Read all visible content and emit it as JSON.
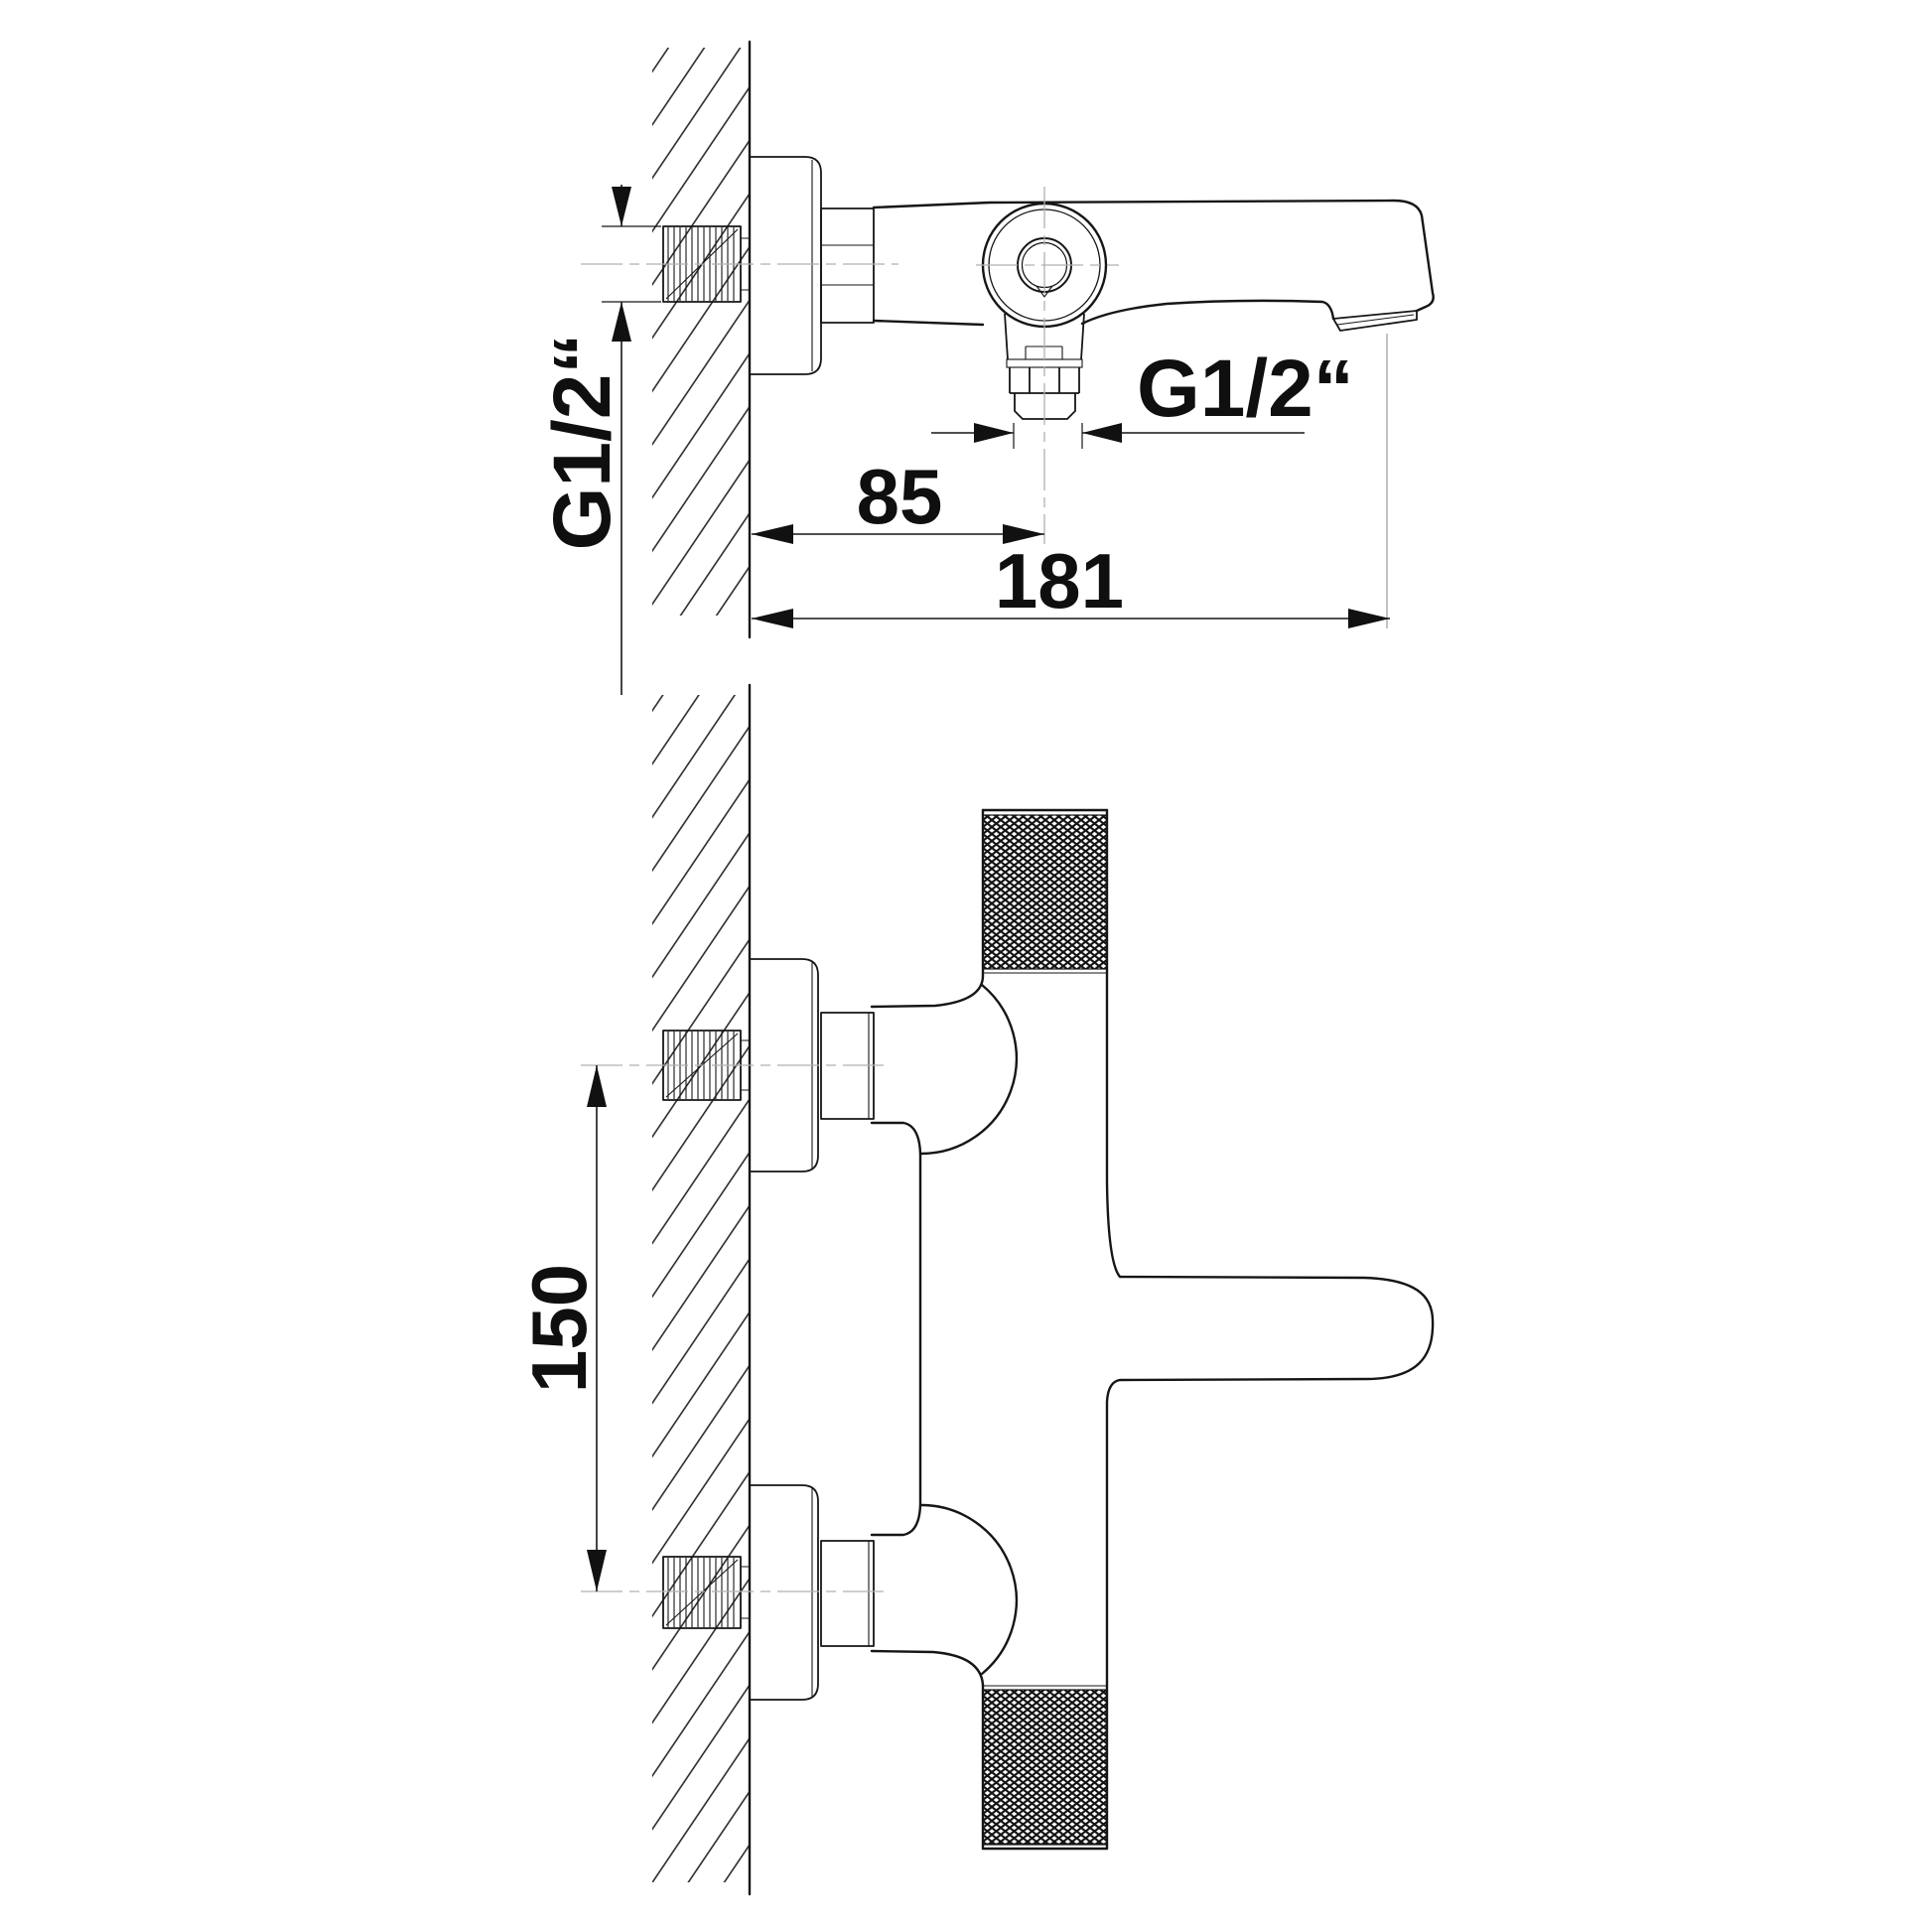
{
  "drawing": {
    "type": "technical-drawing",
    "subject": "wall-mounted bath/shower mixer tap, two orthographic views",
    "background_color": "#ffffff",
    "line_color": "#161616",
    "centerline_color": "#b0b0b0",
    "views": {
      "top_view": "plan/side view of spout body with control dial and downward hose outlet",
      "front_view": "elevation of vertical mixer body with two knurled knobs and lever"
    },
    "dimensions": {
      "wall_to_outlet_center": "85",
      "wall_to_spout_tip": "181",
      "inlet_spacing": "150"
    },
    "labels": {
      "inlet_thread": "G1/2“",
      "outlet_thread": "G1/2“"
    }
  }
}
